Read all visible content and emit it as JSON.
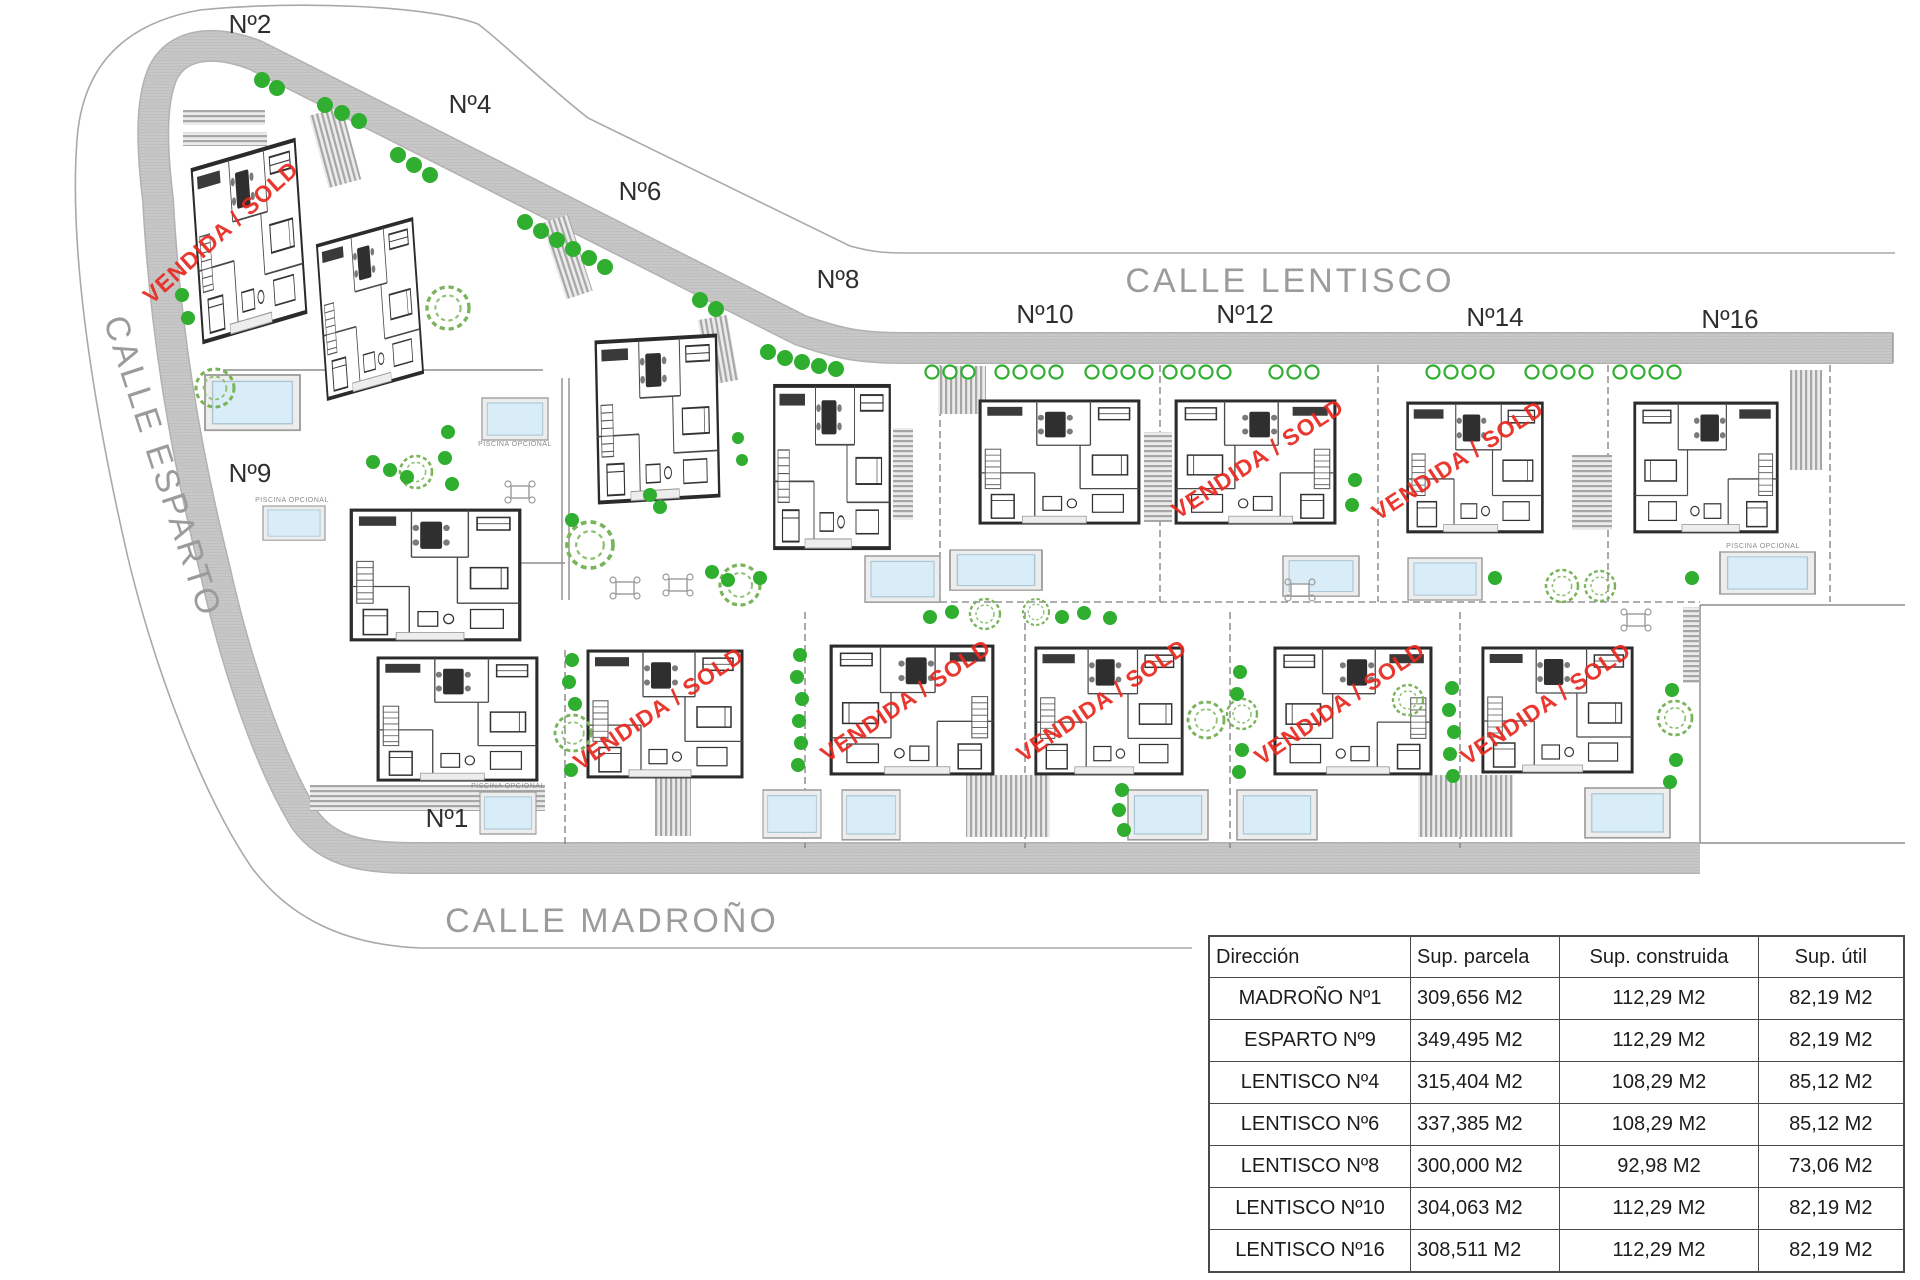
{
  "streets": {
    "lentisco": "CALLE LENTISCO",
    "esparto": "CALLE ESPARTO",
    "madrono": "CALLE MADROÑO"
  },
  "plots": {
    "n1": "Nº1",
    "n2": "Nº2",
    "n4": "Nº4",
    "n6": "Nº6",
    "n8": "Nº8",
    "n9": "Nº9",
    "n10": "Nº10",
    "n12": "Nº12",
    "n14": "Nº14",
    "n16": "Nº16"
  },
  "sold_stamp": "VENDIDA / SOLD",
  "pool_caption": "PISCINA OPCIONAL",
  "table": {
    "headers": [
      "Dirección",
      "Sup. parcela",
      "Sup. construida",
      "Sup. útil"
    ],
    "rows": [
      {
        "direccion": "MADROÑO Nº1",
        "parcela": "309,656 M2",
        "construida": "112,29 M2",
        "util": "82,19 M2"
      },
      {
        "direccion": "ESPARTO Nº9",
        "parcela": "349,495 M2",
        "construida": "112,29 M2",
        "util": "82,19 M2"
      },
      {
        "direccion": "LENTISCO Nº4",
        "parcela": "315,404 M2",
        "construida": "108,29 M2",
        "util": "85,12 M2"
      },
      {
        "direccion": "LENTISCO Nº6",
        "parcela": "337,385 M2",
        "construida": "108,29 M2",
        "util": "85,12 M2"
      },
      {
        "direccion": "LENTISCO Nº8",
        "parcela": "300,000 M2",
        "construida": "92,98 M2",
        "util": "73,06 M2"
      },
      {
        "direccion": "LENTISCO Nº10",
        "parcela": "304,063 M2",
        "construida": "112,29 M2",
        "util": "82,19 M2"
      },
      {
        "direccion": "LENTISCO Nº16",
        "parcela": "308,511 M2",
        "construida": "112,29 M2",
        "util": "82,19 M2"
      }
    ]
  },
  "colors": {
    "stamp_red": "#e8281e",
    "road_gray": "#c9c9c9",
    "tree_green": "#2fae2f",
    "pool_blue": "#d9edf8",
    "street_text": "#9b9b9b",
    "label_text": "#2e2e2e"
  }
}
